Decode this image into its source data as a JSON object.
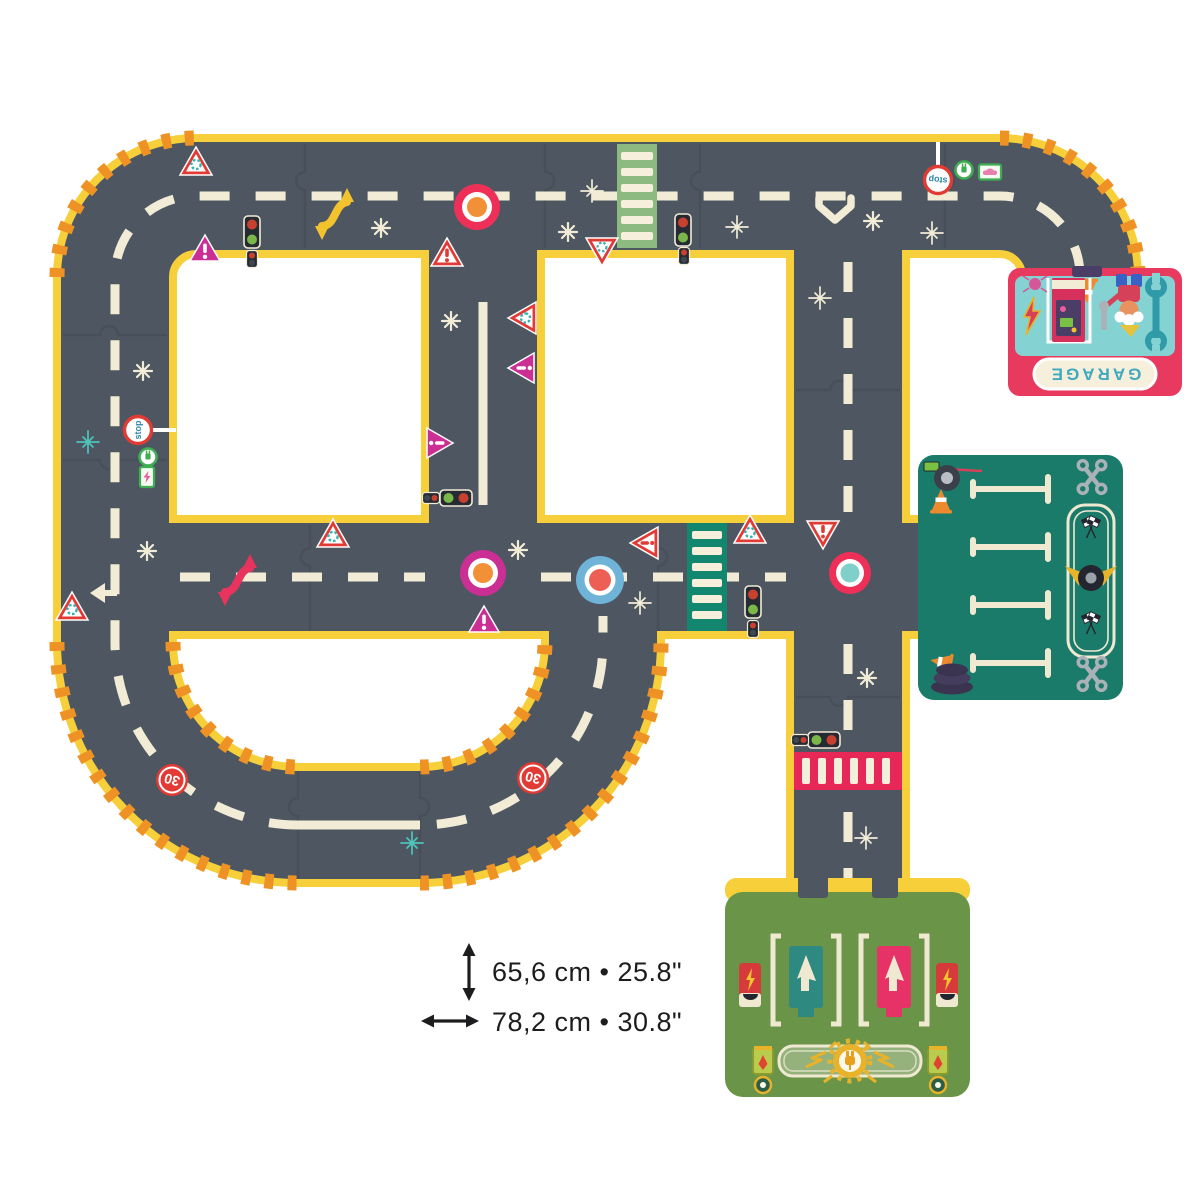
{
  "garage_piece": {
    "label": "GARAGE"
  },
  "road_signs": {
    "stop_label": "stop",
    "speed_limit": "30"
  },
  "dimensions": {
    "height_label": "65,6 cm • 25.8\"",
    "width_label": "78,2 cm • 30.8\""
  },
  "palette": {
    "bg": "#ffffff",
    "road": "#4e5761",
    "edge": "#f6cf3a",
    "hazard": "#ef9226",
    "mark": "#f2ecd7",
    "seam": "#414a53",
    "signred": "#e23a34",
    "magenta": "#cb2f94",
    "teal2": "#35b2b0",
    "green2": "#3fae52",
    "xwgreen": "#8cba80",
    "xwteal": "#13866f",
    "xwpink": "#e72757",
    "ringpink": "#ee3058",
    "ringmagenta": "#cb2f94",
    "ringblue": "#6fb3d9",
    "centerorange": "#f29037",
    "centersalmon": "#ed5f55",
    "centerteal": "#7fd0c8",
    "gteal": "#85d2d2",
    "gpink": "#e8395e",
    "gtext": "#3fa9bf",
    "pteal": "#1b7b6b",
    "grass": "#6a9447",
    "steal": "#2e8a80",
    "spink": "#e73268",
    "gold": "#e8b32a",
    "cream": "#f5efdc",
    "ink": "#1d1d1f"
  }
}
